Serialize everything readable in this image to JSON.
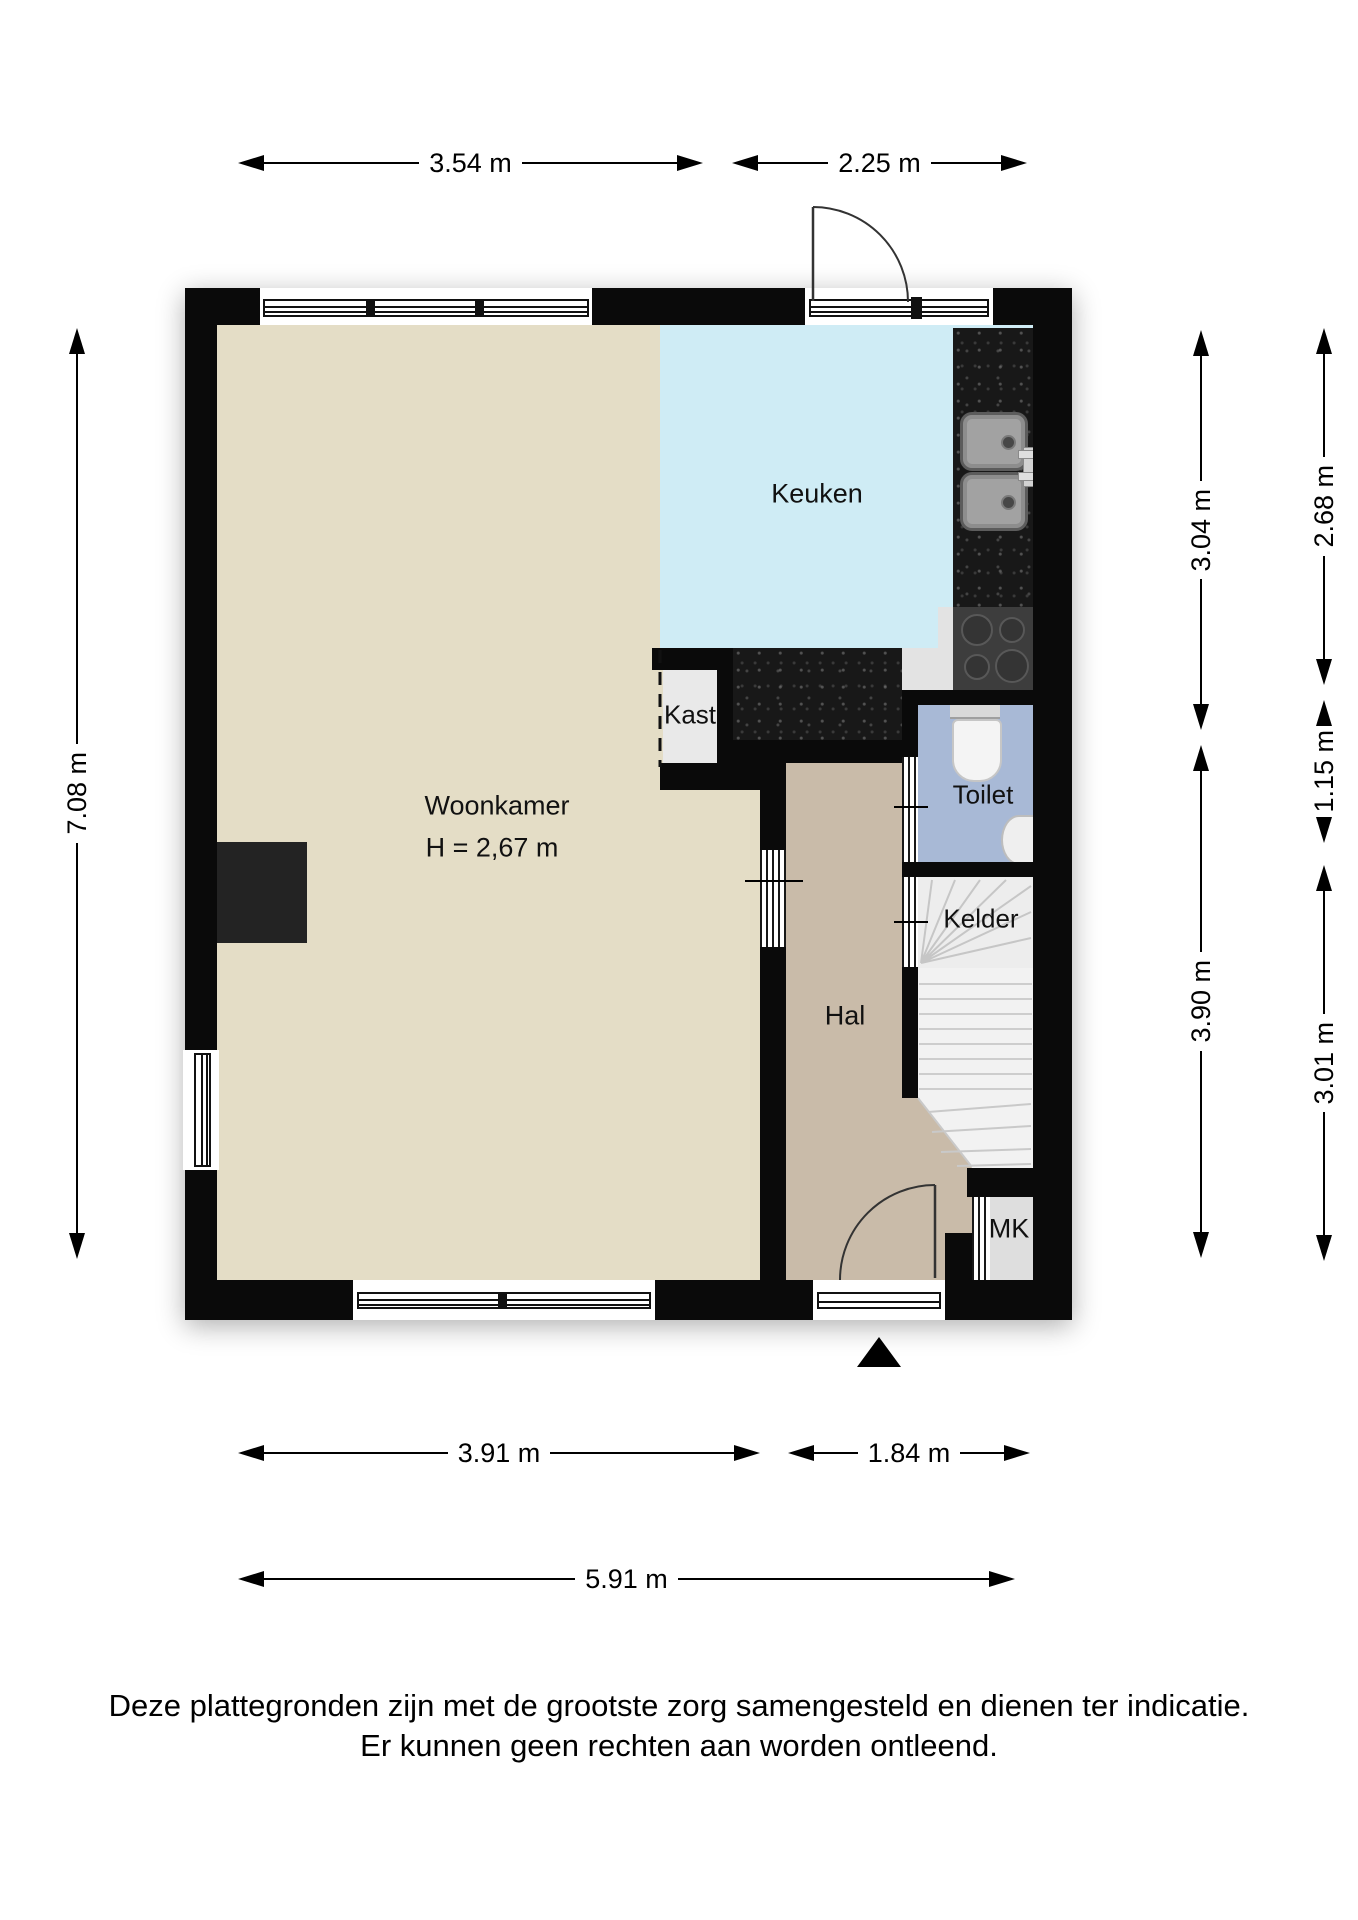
{
  "rooms": {
    "woonkamer": {
      "label": "Woonkamer",
      "ceiling_height": "H = 2,67 m"
    },
    "keuken": {
      "label": "Keuken"
    },
    "kast": {
      "label": "Kast"
    },
    "toilet": {
      "label": "Toilet"
    },
    "kelder": {
      "label": "Kelder"
    },
    "hal": {
      "label": "Hal"
    },
    "mk": {
      "label": "MK"
    }
  },
  "dimensions": {
    "top_left": "3.54 m",
    "top_right": "2.25 m",
    "left": "7.08 m",
    "right_inner_top": "3.04 m",
    "right_inner_bottom": "3.90 m",
    "right_outer_top": "2.68 m",
    "right_outer_middle": "1.15 m",
    "right_outer_bottom": "3.01 m",
    "bottom_left": "3.91 m",
    "bottom_right": "1.84 m",
    "bottom_total": "5.91 m"
  },
  "footer": {
    "line1": "Deze plattegronden zijn met de grootste zorg samengesteld en dienen ter indicatie.",
    "line2": "Er kunnen geen rechten aan worden ontleend."
  },
  "colors": {
    "wall": "#0a0a0a",
    "woonkamer": "#e4ddc6",
    "keuken": "#cfecf5",
    "hal": "#c9bba9",
    "toilet": "#a8b9d6",
    "kast": "#e9e9e9",
    "mk": "#dedede",
    "stairs": "#f2f2f2",
    "kelder": "#ededed",
    "counter": "#181818",
    "stove": "#3d3d3d"
  }
}
